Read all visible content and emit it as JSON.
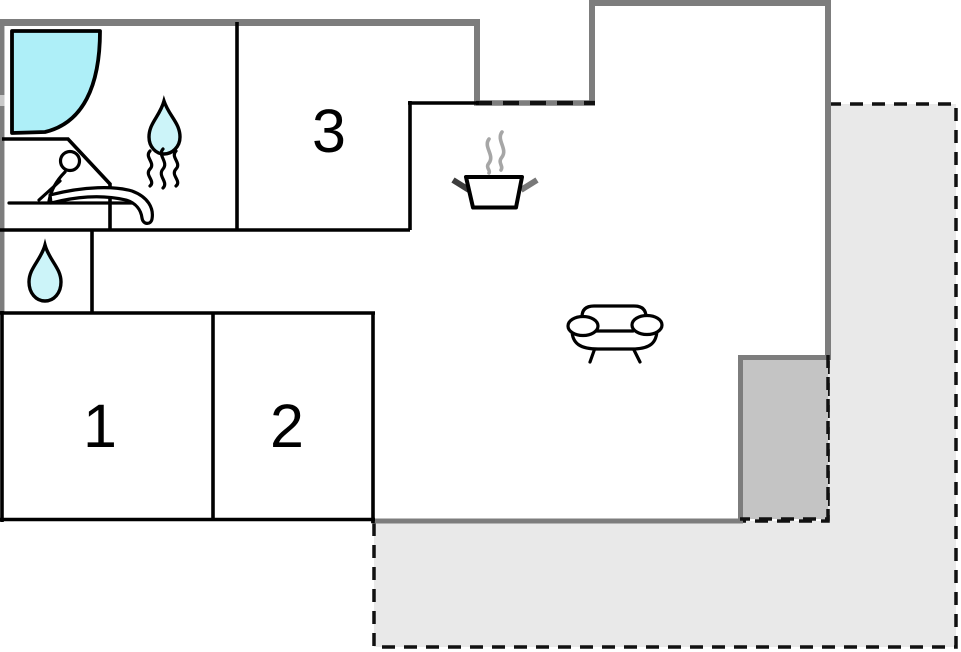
{
  "rooms": {
    "room1": {
      "label": "1"
    },
    "room2": {
      "label": "2"
    },
    "room3": {
      "label": "3"
    }
  },
  "icons": {
    "bathroom_shower": "shower-icon",
    "bathroom_drop": "water-drop-icon",
    "sauna": "sauna-icon",
    "wc_drop": "water-drop-icon",
    "kitchen": "cooking-pot-icon",
    "living_room": "sofa-icon"
  },
  "colors": {
    "background": "#ffffff",
    "wall_outer": "#7d7d7d",
    "wall_inner": "#000000",
    "water_fill": "#aeeff8",
    "drop_fill": "#ccf4f9",
    "terrace_fill": "#e9e9e9",
    "covered_area_fill": "#c4c4c4",
    "steam_gray": "#a6a6a6",
    "handle_dark": "#3d3d3d",
    "handle_gray": "#787878"
  }
}
